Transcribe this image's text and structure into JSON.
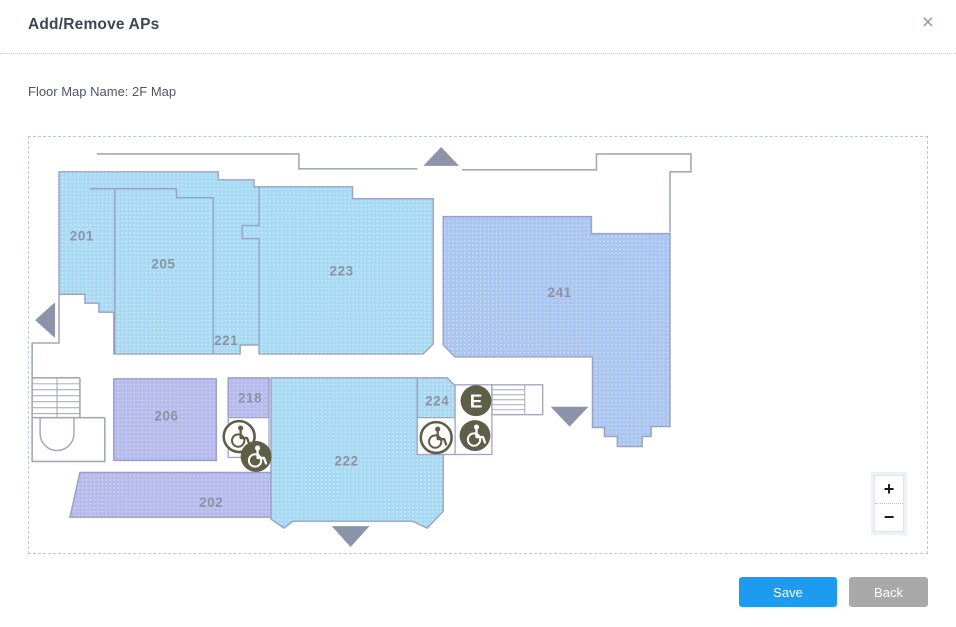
{
  "window": {
    "title": "Add/Remove APs",
    "close_label": "×"
  },
  "form": {
    "floor_map_label": "Floor Map Name: 2F Map"
  },
  "map": {
    "name": "2F Map",
    "rooms": [
      {
        "label": "201"
      },
      {
        "label": "205"
      },
      {
        "label": "221"
      },
      {
        "label": "223"
      },
      {
        "label": "241"
      },
      {
        "label": "206"
      },
      {
        "label": "218"
      },
      {
        "label": "224"
      },
      {
        "label": "222"
      },
      {
        "label": "202"
      }
    ],
    "elevator_label": "E",
    "zoom_in_label": "+",
    "zoom_out_label": "−"
  },
  "footer": {
    "save_label": "Save",
    "back_label": "Back"
  },
  "colors": {
    "save_button": "#1d9bf1",
    "back_button": "#a9a9a9",
    "room_light_blue": "#a8daf3",
    "room_periwinkle": "#aac6f0",
    "room_lavender": "#b6bbec",
    "wall_gray": "#a5a8b8",
    "arrow_gray": "#8d93a8",
    "icon_olive": "#5e5e49",
    "accent_title": "#3d4453"
  }
}
